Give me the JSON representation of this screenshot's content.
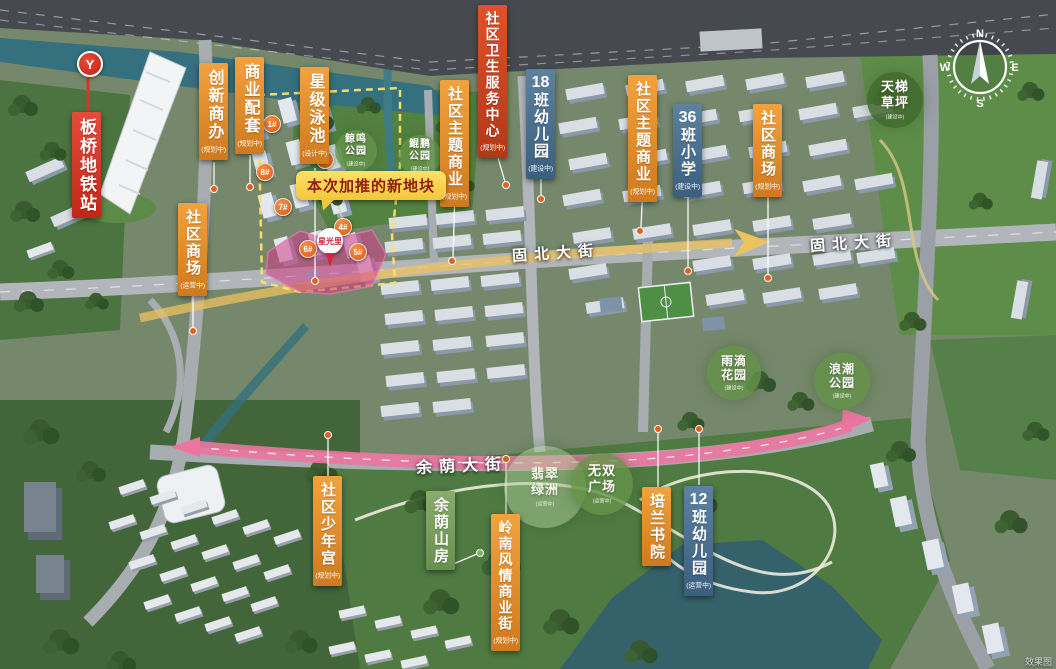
{
  "title": "星光里项目区位示意总平图",
  "watermark": "效果图",
  "compass": {
    "n": "N",
    "e": "E",
    "s": "S",
    "w": "W"
  },
  "metro": {
    "label": "板桥地铁站",
    "logo_glyph": "Y"
  },
  "callout": {
    "text": "本次加推的新地块"
  },
  "pin": {
    "label": "星光里"
  },
  "streets": {
    "gubei_1": "固北大街",
    "gubei_2": "固北大街",
    "yuyin": "余荫大街"
  },
  "banners": [
    {
      "num": "",
      "label": "创新商办",
      "status": "(规划中)",
      "color": "orange"
    },
    {
      "num": "",
      "label": "商业配套",
      "status": "(规划中)",
      "color": "orange"
    },
    {
      "num": "",
      "label": "星级泳池",
      "status": "(设计中)",
      "color": "orange"
    },
    {
      "num": "",
      "label": "社区商场",
      "status": "(运营中)",
      "color": "orange"
    },
    {
      "num": "",
      "label": "社区主题商业",
      "status": "(规划中)",
      "color": "orange"
    },
    {
      "num": "",
      "label": "社区卫生服务中心",
      "status": "(规划中)",
      "color": "redorange"
    },
    {
      "num": "18",
      "label": "班幼儿园",
      "status": "(建设中)",
      "color": "blue"
    },
    {
      "num": "",
      "label": "社区主题商业",
      "status": "(规划中)",
      "color": "orange"
    },
    {
      "num": "36",
      "label": "班小学",
      "status": "(建设中)",
      "color": "blue"
    },
    {
      "num": "",
      "label": "社区商场",
      "status": "(规划中)",
      "color": "orange"
    },
    {
      "num": "",
      "label": "社区少年宫",
      "status": "(规划中)",
      "color": "orange"
    },
    {
      "num": "",
      "label": "余荫山房",
      "status": "",
      "color": "green"
    },
    {
      "num": "",
      "label": "岭南风情商业街",
      "status": "(规划中)",
      "color": "orange"
    },
    {
      "num": "",
      "label": "培兰书院",
      "status": "",
      "color": "orange"
    },
    {
      "num": "12",
      "label": "班幼儿园",
      "status": "(运营中)",
      "color": "blue"
    }
  ],
  "parks": [
    {
      "line1": "鲸鸣",
      "line2": "公园",
      "status": "(建设中)"
    },
    {
      "line1": "鲲鹏",
      "line2": "公园",
      "status": "(建设中)"
    },
    {
      "line1": "天梯",
      "line2": "草坪",
      "status": "(建设中)"
    },
    {
      "line1": "雨滴",
      "line2": "花园",
      "status": "(建设中)"
    },
    {
      "line1": "浪潮",
      "line2": "公园",
      "status": "(建设中)"
    },
    {
      "line1": "无双",
      "line2": "广场",
      "status": "(运营中)"
    },
    {
      "line1": "翡翠",
      "line2": "绿洲",
      "status": "(运营中)"
    }
  ],
  "buildings": [
    {
      "label": "1#"
    },
    {
      "label": "3#"
    },
    {
      "label": "8#"
    },
    {
      "label": "7#"
    },
    {
      "label": "4#"
    },
    {
      "label": "6#"
    },
    {
      "label": "5#"
    }
  ]
}
